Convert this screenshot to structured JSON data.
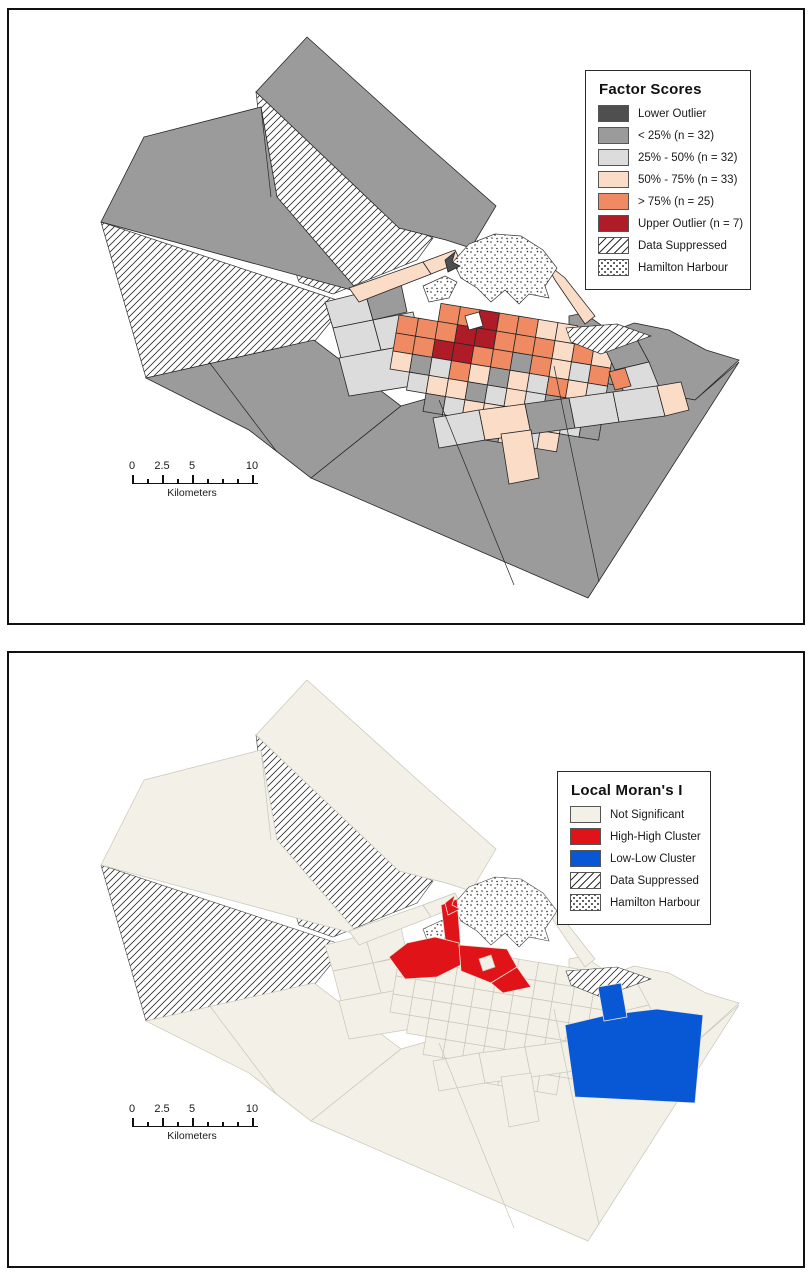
{
  "page": {
    "background": "#ffffff",
    "frame_color": "#111111"
  },
  "panels": [
    {
      "id": "factor-scores",
      "legend": {
        "title": "Factor Scores",
        "items": [
          {
            "label": "Lower Outlier",
            "type": "fill",
            "color": "#4f4f4f"
          },
          {
            "label": "< 25% (n = 32)",
            "type": "fill",
            "color": "#9b9b9b"
          },
          {
            "label": "25% - 50% (n = 32)",
            "type": "fill",
            "color": "#dcdcdc"
          },
          {
            "label": "50% - 75% (n = 33)",
            "type": "fill",
            "color": "#fbdcc7"
          },
          {
            "label": "> 75% (n = 25)",
            "type": "fill",
            "color": "#ef8a62"
          },
          {
            "label": "Upper Outlier (n = 7)",
            "type": "fill",
            "color": "#ae1c28"
          },
          {
            "label": "Data Suppressed",
            "type": "hatch"
          },
          {
            "label": "Hamilton Harbour",
            "type": "stipple"
          }
        ]
      },
      "colors": {
        "lower": "#4f4f4f",
        "q25": "#9b9b9b",
        "q2550": "#dcdcdc",
        "q5075": "#fbdcc7",
        "q75": "#ef8a62",
        "upper": "#ae1c28",
        "white": "#ffffff"
      },
      "scalebar": {
        "tick_labels": [
          "0",
          "2.5",
          "5",
          "10"
        ],
        "unit_label": "Kilometers"
      }
    },
    {
      "id": "local-morans-i",
      "legend": {
        "title": "Local Moran's I",
        "items": [
          {
            "label": "Not Significant",
            "type": "fill",
            "color": "#f2f0e7"
          },
          {
            "label": "High-High Cluster",
            "type": "fill",
            "color": "#e01318"
          },
          {
            "label": "Low-Low Cluster",
            "type": "fill",
            "color": "#0857d4"
          },
          {
            "label": "Data Suppressed",
            "type": "hatch"
          },
          {
            "label": "Hamilton Harbour",
            "type": "stipple"
          }
        ]
      },
      "colors": {
        "notsig": "#f2f0e7",
        "hh": "#e01318",
        "ll": "#0857d4",
        "white": "#f2f0e7"
      },
      "scalebar": {
        "tick_labels": [
          "0",
          "2.5",
          "5",
          "10"
        ],
        "unit_label": "Kilometers"
      }
    }
  ]
}
